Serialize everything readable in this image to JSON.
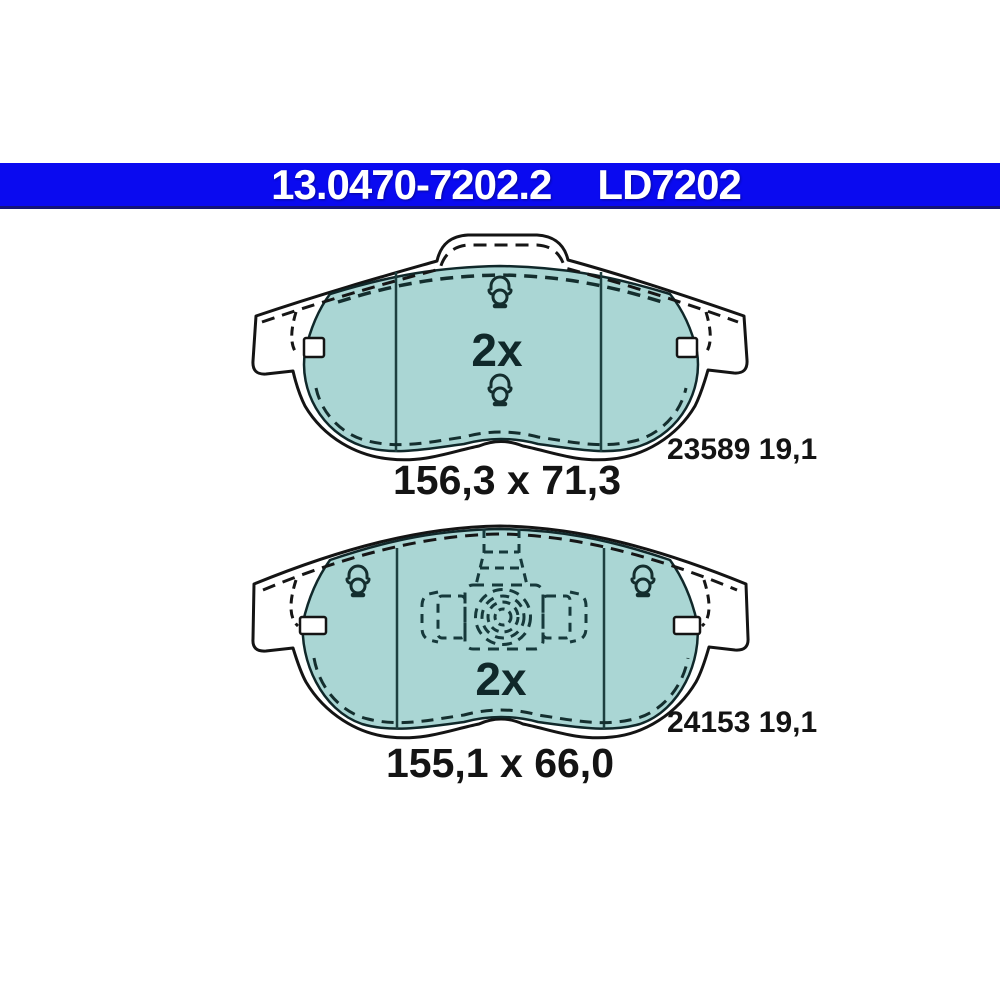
{
  "header": {
    "part_number": "13.0470-7202.2",
    "trade_code": "LD7202",
    "bg_color": "#0a0af0",
    "text_color": "#ffffff"
  },
  "drawings": [
    {
      "name": "front-brake-pad-upper",
      "quantity_label": "2x",
      "dimensions_label": "156,3 x 71,3",
      "ref_label": "23589 19,1"
    },
    {
      "name": "front-brake-pad-lower",
      "quantity_label": "2x",
      "dimensions_label": "155,1 x 66,0",
      "ref_label": "24153 19,1"
    }
  ],
  "colors": {
    "friction_material": "#aad6d4",
    "plate_fill": "#ffffff",
    "outline": "#141414",
    "detail_dash": "#16393b"
  }
}
